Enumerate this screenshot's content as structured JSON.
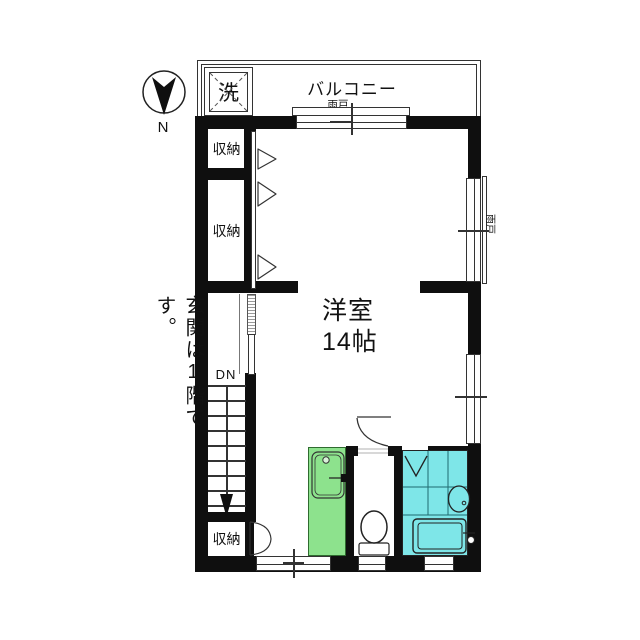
{
  "plan": {
    "compass": {
      "label": "N"
    },
    "balcony": {
      "label": "バルコニー",
      "shutter_label": "雨戸"
    },
    "laundry": {
      "label": "洗"
    },
    "storage_top": {
      "label": "収納"
    },
    "storage_middle": {
      "label": "収納"
    },
    "storage_bottom": {
      "label": "収納"
    },
    "room": {
      "name": "洋室",
      "size": "14帖"
    },
    "stairs": {
      "label": "DN"
    },
    "side_window": {
      "shutter_label": "雨戸"
    },
    "note": {
      "text": "玄関は1階です。"
    },
    "colors": {
      "wall": "#0f0f0f",
      "kitchen_green": "#8DE28D",
      "bath_cyan": "#7EE6E8",
      "line": "#333333"
    }
  }
}
